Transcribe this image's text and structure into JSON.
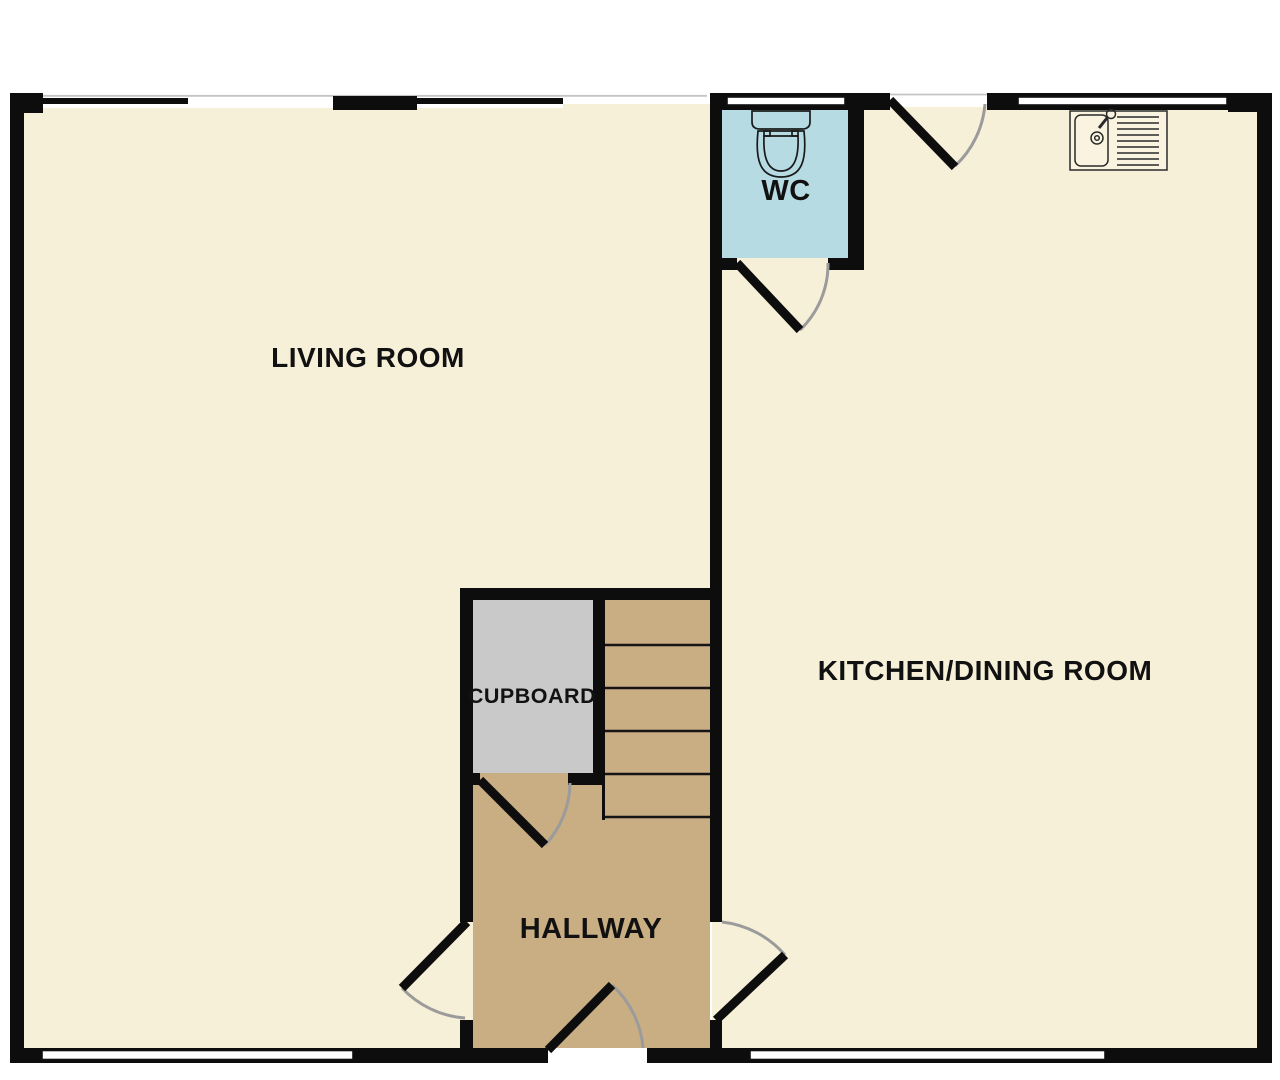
{
  "floorplan": {
    "title": "Ground floor plan",
    "colors": {
      "wall": "#0d0d0d",
      "floor_cream": "#f7f0d8",
      "wc_blue": "#b7dbe3",
      "hall_tan": "#c9ad83",
      "cupboard_gray": "#c9c9c9",
      "door_arc": "#9b9b9b",
      "window_white": "#ffffff",
      "label_text": "#111111",
      "outside": "#ffffff"
    },
    "rooms": [
      {
        "id": "living-room",
        "label": "LIVING ROOM",
        "fill": "#f7f0d8"
      },
      {
        "id": "wc",
        "label": "WC",
        "fill": "#b7dbe3"
      },
      {
        "id": "kitchen-dining-room",
        "label": "KITCHEN/DINING ROOM",
        "fill": "#f7f0d8"
      },
      {
        "id": "cupboard",
        "label": "CUPBOARD",
        "fill": "#c9c9c9"
      },
      {
        "id": "hallway",
        "label": "HALLWAY",
        "fill": "#c9ad83"
      }
    ],
    "fixtures": [
      {
        "id": "toilet-icon"
      },
      {
        "id": "kitchen-sink-icon"
      }
    ],
    "stairs": {
      "visible_steps": 5
    },
    "doors": {
      "count": 6
    },
    "windows": {
      "count": 4
    }
  }
}
